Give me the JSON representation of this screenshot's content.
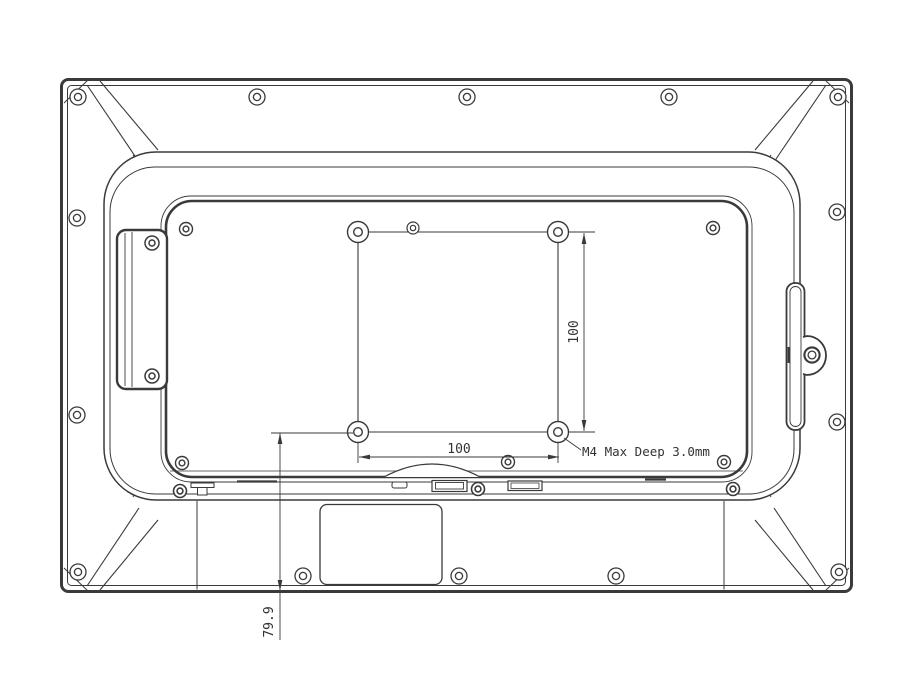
{
  "drawing": {
    "type": "technical-drawing",
    "subject": "display-rear-view-with-vesa-mount",
    "labels": {
      "vesa_horizontal_dim": "100",
      "vesa_vertical_dim": "100",
      "bottom_offset_dim": "79.9",
      "mount_hole_note": "M4 Max Deep 3.0mm"
    },
    "colors": {
      "line": "#3a3a3a",
      "background": "#ffffff"
    }
  }
}
